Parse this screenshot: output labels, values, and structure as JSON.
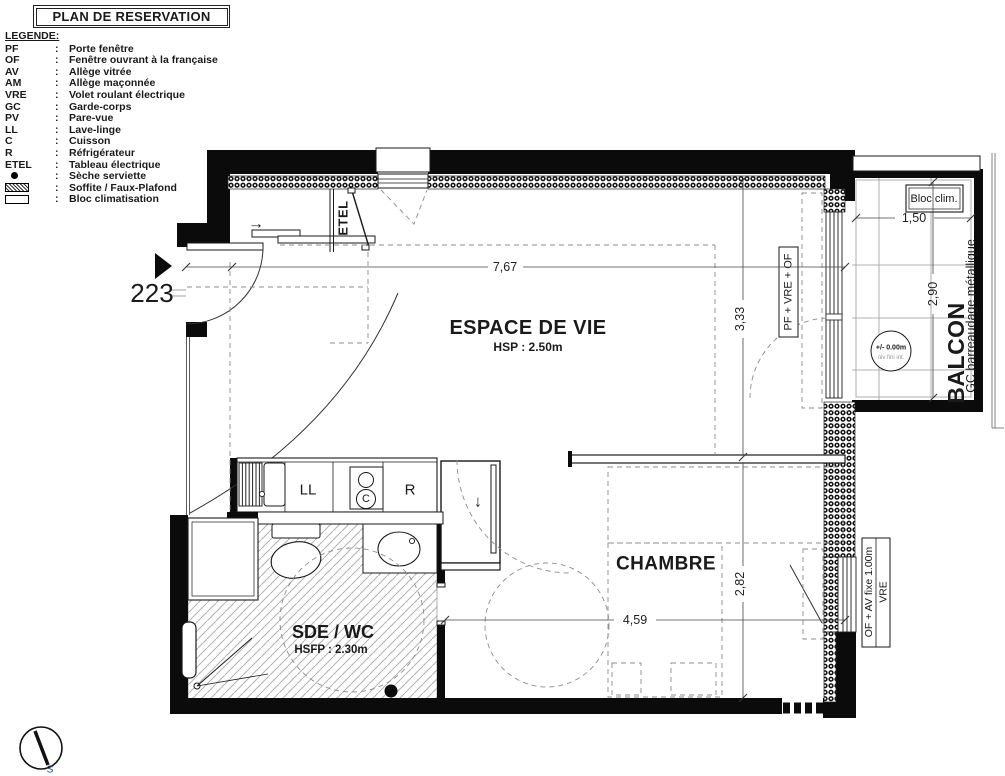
{
  "title": "PLAN DE RESERVATION",
  "legend": {
    "heading": "LEGENDE:",
    "sep": ":",
    "items": [
      {
        "abbr": "PF",
        "desc": "Porte fenêtre"
      },
      {
        "abbr": "OF",
        "desc": "Fenêtre ouvrant à la française"
      },
      {
        "abbr": "AV",
        "desc": "Allège vitrée"
      },
      {
        "abbr": "AM",
        "desc": "Allège maçonnée"
      },
      {
        "abbr": "VRE",
        "desc": "Volet roulant électrique"
      },
      {
        "abbr": "GC",
        "desc": "Garde-corps"
      },
      {
        "abbr": "PV",
        "desc": "Pare-vue"
      },
      {
        "abbr": "LL",
        "desc": "Lave-linge"
      },
      {
        "abbr": "C",
        "desc": "Cuisson"
      },
      {
        "abbr": "R",
        "desc": "Réfrigérateur"
      },
      {
        "abbr": "ETEL",
        "desc": "Tableau électrique"
      },
      {
        "abbr": "",
        "desc": "Sèche serviette",
        "swatch": "dot"
      },
      {
        "abbr": "",
        "desc": "Soffite / Faux-Plafond",
        "swatch": "hatch"
      },
      {
        "abbr": "",
        "desc": "Bloc climatisation",
        "swatch": "box"
      }
    ]
  },
  "unit_number": "223",
  "rooms": {
    "living": {
      "name": "ESPACE DE VIE",
      "ceiling": "HSP : 2.50m"
    },
    "bedroom": {
      "name": "CHAMBRE"
    },
    "bathroom": {
      "name": "SDE / WC",
      "ceiling": "HSFP : 2.30m"
    },
    "balcony": {
      "name": "BALCON",
      "railing": "GC barreaudage métallique",
      "ac": "Bloc clim.",
      "level": "+/- 0.00m",
      "level_note": "niv fini int."
    }
  },
  "dims": {
    "living_w": "7,67",
    "living_d": "3,33",
    "bedroom_d": "2,82",
    "bedroom_w": "4,59",
    "balcony_w": "1,50",
    "balcony_d": "2,90"
  },
  "tags": {
    "balcony_door": "PF + VRE + OF",
    "bedroom_window": "OF + AV fixe 1.00m",
    "bedroom_window2": "VRE",
    "etel": "ETEL",
    "ll": "LL",
    "c": "C",
    "r": "R"
  },
  "icons": {
    "arrow_right": "→",
    "arrow_down": "↓",
    "south": "S"
  }
}
